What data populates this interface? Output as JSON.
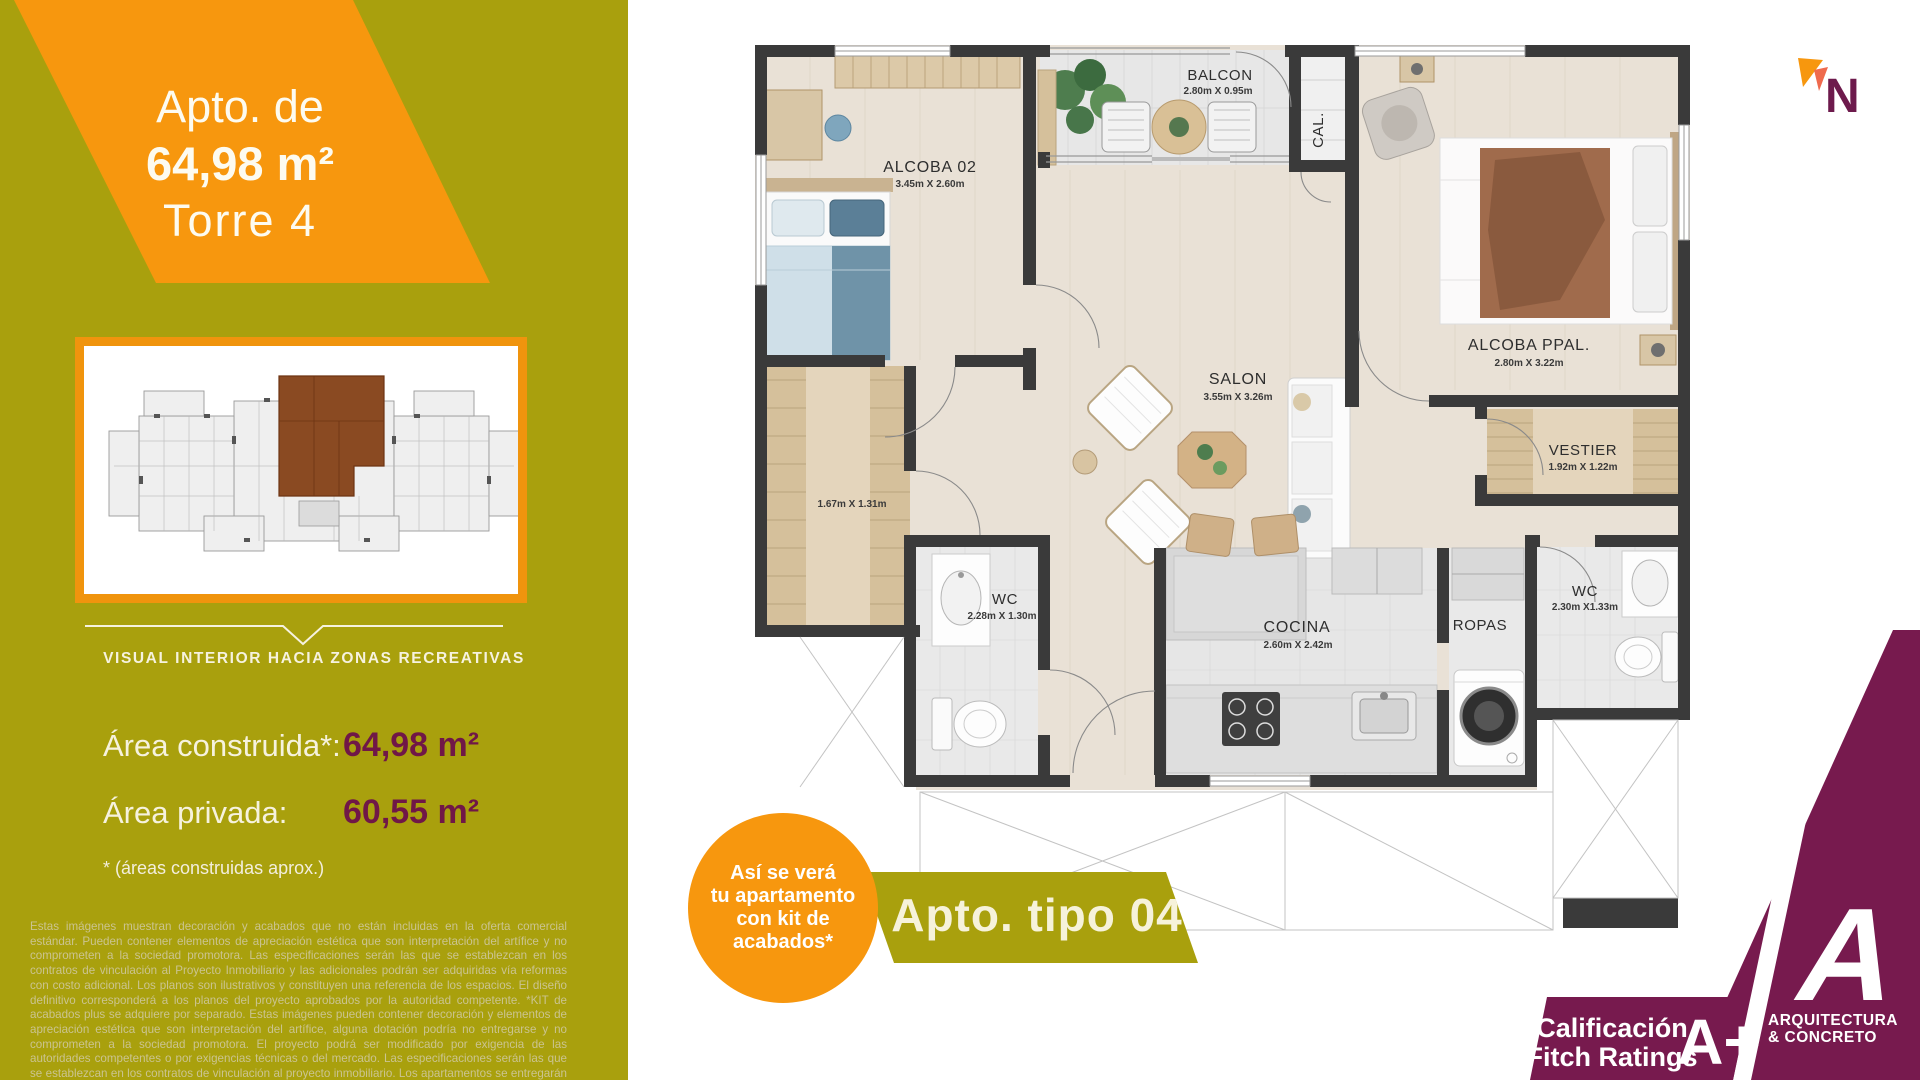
{
  "left": {
    "banner": {
      "line1": "Apto. de",
      "line2": "64,98 m²",
      "line3": "Torre 4"
    },
    "thumbnail_caption": "VISUAL INTERIOR HACIA ZONAS RECREATIVAS",
    "areas": {
      "construida_label": "Área construida*:",
      "construida_value": "64,98 m²",
      "privada_label": "Área privada:",
      "privada_value": "60,55 m²",
      "footnote": "* (áreas construidas aprox.)"
    },
    "legal": "Estas imágenes muestran decoración y acabados que no están incluidas en la oferta comercial estándar. Pueden contener elementos de apreciación estética que son interpretación del artífice y no comprometen a la sociedad promotora. Las especificaciones serán las que se establezcan en los contratos de vinculación al Proyecto Inmobiliario y las adicionales podrán ser adquiridas vía reformas con costo adicional. Los planos son ilustrativos y constituyen una referencia de los espacios. El diseño definitivo corresponderá a los planos del proyecto aprobados por la autoridad competente. *KIT de acabados plus se adquiere por separado. Estas imágenes pueden contener decoración y elementos de apreciación estética que son interpretación del artífice, alguna dotación podría no entregarse y no comprometen a la sociedad promotora. El proyecto podrá ser modificado por exigencia de las autoridades competentes o por exigencias técnicas o del mercado. Las especificaciones serán las que se establezcan en los contratos de vinculación al proyecto inmobiliario. Los apartamentos se entregarán en obra gris."
  },
  "plan": {
    "rooms": [
      {
        "name": "ALCOBA 02",
        "dims": "3.45m X 2.60m"
      },
      {
        "name": "BALCON",
        "dims": "2.80m X 0.95m"
      },
      {
        "name": "CAL.",
        "dims": ""
      },
      {
        "name": "ALCOBA PPAL.",
        "dims": "2.80m X 3.22m"
      },
      {
        "name": "SALON",
        "dims": "3.55m X 3.26m"
      },
      {
        "name": "VESTIER",
        "dims": "1.67m X 1.31m"
      },
      {
        "name": "WC",
        "dims": "2.28m X 1.30m"
      },
      {
        "name": "COCINA",
        "dims": "2.60m X 2.42m"
      },
      {
        "name": "ROPAS",
        "dims": ""
      },
      {
        "name": "VESTIER",
        "dims": "1.92m X 1.22m"
      },
      {
        "name": "WC",
        "dims": "2.30m X1.33m"
      }
    ]
  },
  "badges": {
    "kit_circle": {
      "line1": "Así se verá",
      "line2": "tu apartamento",
      "line3": "con kit de",
      "line4": "acabados*"
    },
    "apto_tipo": "Apto. tipo 04"
  },
  "compass": {
    "letter": "N"
  },
  "footer": {
    "rating": {
      "line1": "Calificación",
      "line2": "Fitch Ratings",
      "grade": "A+"
    },
    "logo": {
      "letter": "A",
      "line1": "ARQUITECTURA",
      "line2": "& CONCRETO"
    }
  },
  "colors": {
    "olive": "#a9a00d",
    "orange": "#f7970e",
    "maroon": "#771a4e",
    "value_maroon": "#701747",
    "cream": "#f6f2df",
    "wall": "#3a3a3a"
  }
}
